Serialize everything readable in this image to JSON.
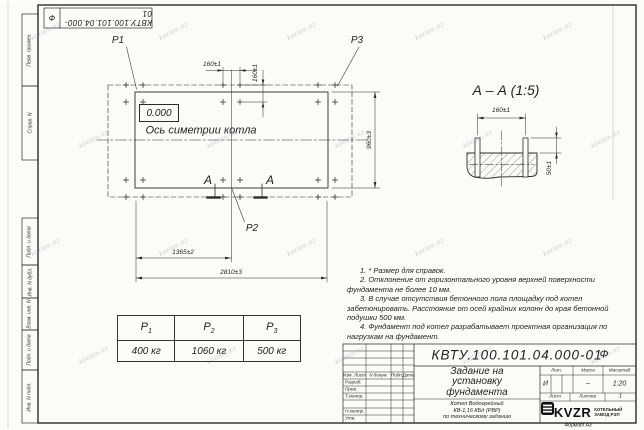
{
  "sheet": {
    "watermark": "kotlam.kz",
    "format": "Формат А3"
  },
  "side_columns": {
    "top": [
      "Перв. примен.",
      "Справ. N"
    ],
    "bottom": [
      "Подп. и дата",
      "Инв. N дубл.",
      "Взам. инв. N",
      "Подп. и дата",
      "Инв. N подл."
    ]
  },
  "top_stamp": {
    "number": "КВТУ.100.101.04.000-01",
    "suffix": "Ф"
  },
  "plan": {
    "labels": {
      "p1": "P1",
      "p2": "P2",
      "p3": "P3"
    },
    "level_mark": "0.000",
    "axis_caption": "Ось симетрии котла",
    "section_letter": "А",
    "dims": {
      "bolt_h": "160±1",
      "bolt_v": "160±1",
      "width": "960±3",
      "half_length": "1365±2",
      "length": "2810±3"
    }
  },
  "section": {
    "title": "А – А (1:5)",
    "dims": {
      "bolt": "160±1",
      "protrusion": "50±1"
    }
  },
  "loads_table": {
    "headers": [
      {
        "base": "P",
        "sub": "1"
      },
      {
        "base": "P",
        "sub": "2"
      },
      {
        "base": "P",
        "sub": "3"
      }
    ],
    "values": [
      "400 кг",
      "1060 кг",
      "500 кг"
    ]
  },
  "notes": [
    "1. * Размер для справок.",
    "2. Отклонение от горизонтального уровня верхней поверхности фундамента не более 10 мм.",
    "3. В случае отсутствия бетонного пола площадку под котел забетонировать. Расстояние от осей крайних колонн до края бетонной подушки 500 мм.",
    "4. Фундамент под котел разрабатывает проектная организация по нагрузкам на фундамент."
  ],
  "title_block": {
    "doc_number": "КВТУ.100.101.04.000-01",
    "doc_suffix": "Ф",
    "header_cols": [
      "Изм. Лист",
      "N докум.",
      "Подп.",
      "Дата"
    ],
    "rows": [
      "Разраб.",
      "Пров.",
      "Т.контр.",
      "Н.контр.",
      "Утв."
    ],
    "title": "Задание на установку фундамента",
    "subtitle_lines": [
      "Котел Водогрейный",
      "КВ-1,16 КБд (РВР)",
      "по техническому заданию"
    ],
    "lit_label": "Лит.",
    "lit_value": "И",
    "mass_label": "Масса",
    "mass_value": "–",
    "scale_label": "Масштаб",
    "scale_value": "1:20",
    "sheet_label": "Лист",
    "sheets_label": "Листов",
    "sheets_value": "1",
    "company": "KVZR",
    "company_sub": [
      "КОТЕЛЬНЫЙ",
      "ЗАВОД РЭП"
    ]
  }
}
